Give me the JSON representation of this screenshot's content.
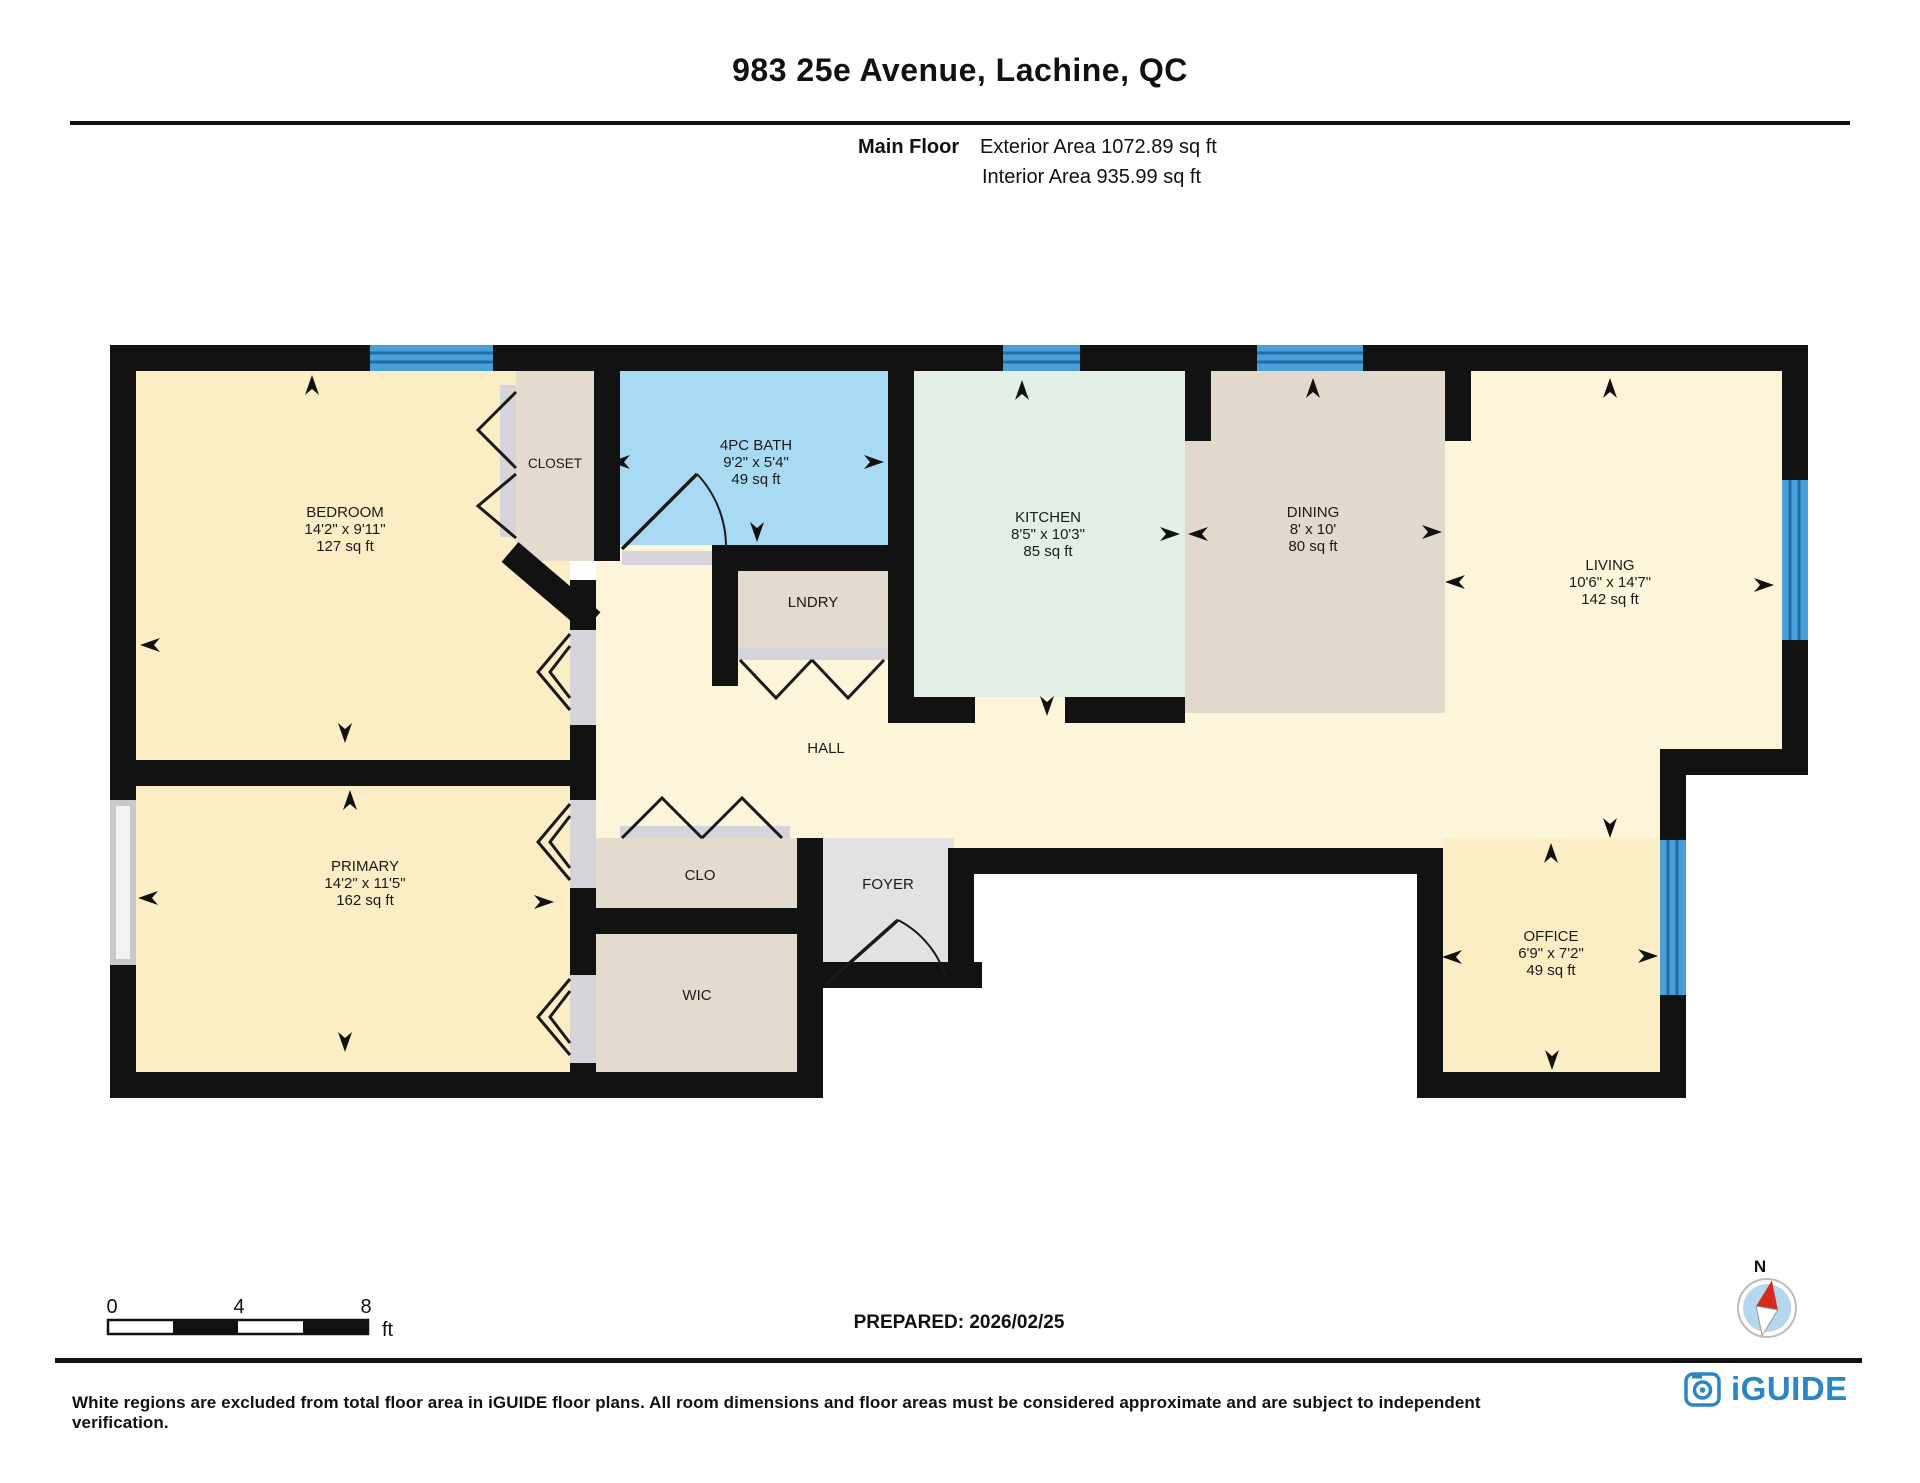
{
  "header": {
    "title": "983 25e Avenue, Lachine, QC",
    "floor_label": "Main Floor",
    "exterior_area": "Exterior Area 1072.89 sq ft",
    "interior_area": "Interior Area 935.99 sq ft"
  },
  "rooms": {
    "bedroom": {
      "name": "BEDROOM",
      "dims": "14'2\" x 9'11\"",
      "area": "127 sq ft"
    },
    "closet": {
      "name": "CLOSET"
    },
    "bath": {
      "name": "4PC BATH",
      "dims": "9'2\" x 5'4\"",
      "area": "49 sq ft"
    },
    "kitchen": {
      "name": "KITCHEN",
      "dims": "8'5\" x 10'3\"",
      "area": "85 sq ft"
    },
    "dining": {
      "name": "DINING",
      "dims": "8' x 10'",
      "area": "80 sq ft"
    },
    "living": {
      "name": "LIVING",
      "dims": "10'6\" x 14'7\"",
      "area": "142 sq ft"
    },
    "lndry": {
      "name": "LNDRY"
    },
    "hall": {
      "name": "HALL"
    },
    "primary": {
      "name": "PRIMARY",
      "dims": "14'2\" x 11'5\"",
      "area": "162 sq ft"
    },
    "clo": {
      "name": "CLO"
    },
    "foyer": {
      "name": "FOYER"
    },
    "wic": {
      "name": "WIC"
    },
    "office": {
      "name": "OFFICE",
      "dims": "6'9\" x 7'2\"",
      "area": "49 sq ft"
    }
  },
  "scale_bar": {
    "tick_0": "0",
    "tick_4": "4",
    "tick_8": "8",
    "unit": "ft"
  },
  "prepared": "PREPARED: 2026/02/25",
  "compass": {
    "north_label": "N"
  },
  "footer": {
    "disclaimer": "White regions are excluded from total floor area in iGUIDE floor plans. All room dimensions and floor areas must be considered approximate and are subject to independent verification.",
    "brand": "iGUIDE"
  },
  "colors": {
    "wall": "#121212",
    "window_blue": "#4aa0d6",
    "window_line": "#1e6da6",
    "cream_light": "#fdf5da",
    "cream_deep": "#fbeec4",
    "tan": "#e3dbcd",
    "kitchen_green": "#e3eee6",
    "bath_blue": "#a9daf4",
    "foyer_gray": "#e2e2e2",
    "brand_blue": "#2b87c4",
    "compass_red": "#d42b1e"
  }
}
